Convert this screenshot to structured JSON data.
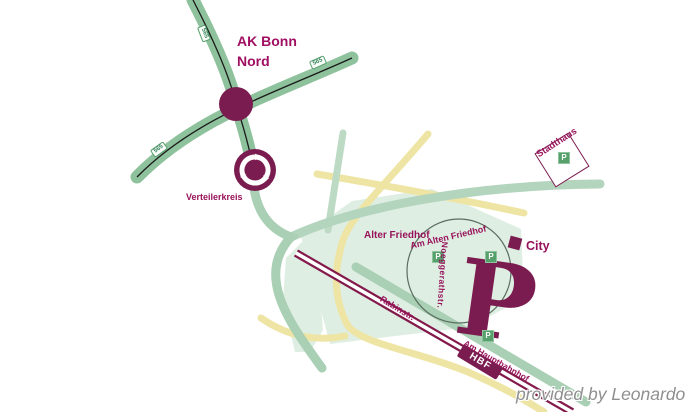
{
  "map": {
    "labels": {
      "junction": "AK Bonn\nNord",
      "roundabout": "Verteilerkreis",
      "park": "Alter Friedhof",
      "street_am_alten_friedhof": "Am Alten Friedhof",
      "street_noeggerathstr": "Noeggerathstr.",
      "city": "City",
      "stadthaus": "Stadthaus",
      "street_rabinstr": "Rabinstr.",
      "street_am_hauptbahnhof": "Am Hauptbahnhof",
      "station": "HBF"
    },
    "road_badges": [
      {
        "label": "565"
      },
      {
        "label": "565"
      },
      {
        "label": "565"
      }
    ],
    "parking_icon": "P",
    "watermark": "provided by Leonardo",
    "colors": {
      "motorway_green": "#8ec29c",
      "road_sage": "#a9cfb4",
      "road_yellow": "#eee4a3",
      "park_fill": "#dfeee3",
      "brand_magenta": "#7b1c50",
      "label_magenta": "#97125a",
      "railway": "#831a4b",
      "parking_green": "#55a06b"
    }
  }
}
